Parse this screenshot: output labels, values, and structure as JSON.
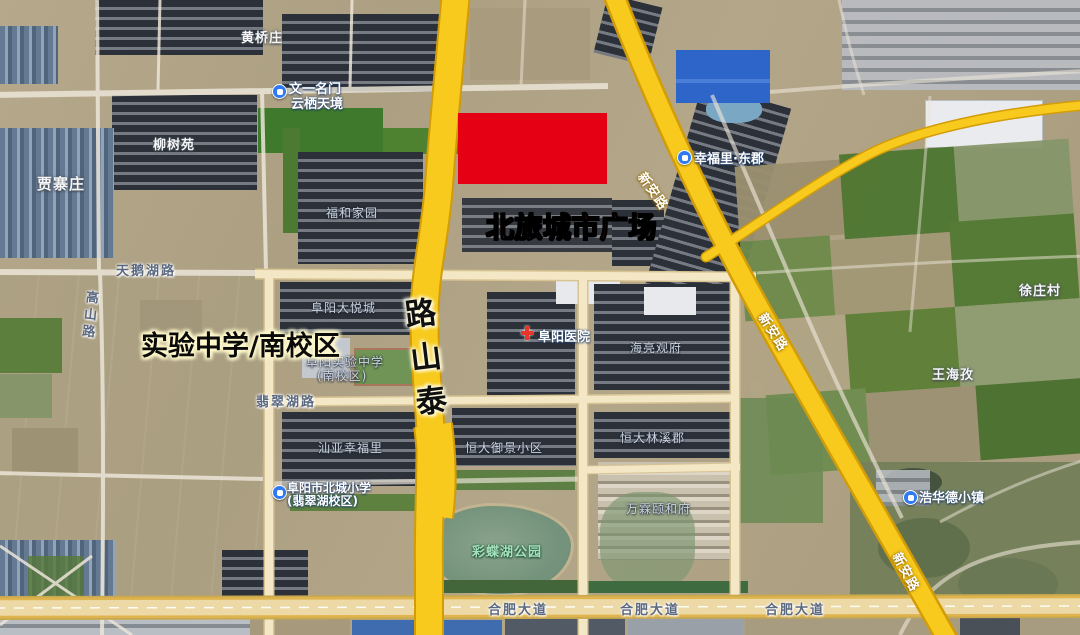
{
  "annotations": {
    "plaza": "北旅城市广场",
    "school": "实验中学/南校区",
    "taishan_chars": [
      "路",
      "山",
      "泰"
    ]
  },
  "roads": {
    "main_vertical": "泰山路",
    "diagonal": "新安路",
    "bottom_avenue": "合肥大道",
    "swan_lake_road": "天鹅湖路",
    "feicui_lake_road": "翡翠湖路",
    "gaoshan_road": "高山路"
  },
  "colors": {
    "highlight_box": "#e60013",
    "plaza_text": "#ff3800",
    "school_text": "#0a0a0a",
    "main_road_yellow": "#f7ca1d",
    "road_casing": "#d29c08"
  },
  "labels": [
    {
      "name": "poi-icon-wenyi",
      "kind": "icon-blue",
      "x": 272,
      "y": 84,
      "inter": true
    },
    {
      "name": "poi-wenyi-line1",
      "cls": "poi",
      "x": 289,
      "y": 78,
      "text": "文一名门",
      "inter": true
    },
    {
      "name": "poi-wenyi-line2",
      "cls": "poi",
      "x": 291,
      "y": 93,
      "text": "云栖天境",
      "inter": true
    },
    {
      "name": "poi-icon-xingfuli",
      "kind": "icon-blue",
      "x": 677,
      "y": 150,
      "inter": true
    },
    {
      "name": "poi-xingfuli",
      "cls": "poi",
      "x": 694,
      "y": 148,
      "text": "幸福里·东郡",
      "inter": true
    },
    {
      "name": "poi-icon-hospital",
      "kind": "icon-cross",
      "x": 520,
      "y": 325,
      "inter": true
    },
    {
      "name": "poi-hospital",
      "cls": "poi",
      "x": 538,
      "y": 326,
      "text": "阜阳医院",
      "inter": true
    },
    {
      "name": "poi-icon-beicheng-school",
      "kind": "icon-blue",
      "x": 272,
      "y": 485,
      "inter": true
    },
    {
      "name": "poi-beicheng-line1",
      "cls": "poi sm",
      "x": 287,
      "y": 479,
      "text": "阜阳市北城小学",
      "inter": true
    },
    {
      "name": "poi-beicheng-line2",
      "cls": "poi sm",
      "x": 287,
      "y": 492,
      "text": "(翡翠湖校区)",
      "inter": true
    },
    {
      "name": "poi-icon-haohuade",
      "kind": "icon-blue",
      "x": 903,
      "y": 490,
      "inter": true
    },
    {
      "name": "poi-haohuade",
      "cls": "poi",
      "x": 919,
      "y": 487,
      "text": "浩华德小镇",
      "inter": true
    },
    {
      "name": "village-jiazhaizhuang",
      "cls": "village lg",
      "x": 37,
      "y": 173,
      "text": "贾寨庄",
      "inter": false
    },
    {
      "name": "village-liushuyuan",
      "cls": "village",
      "x": 153,
      "y": 134,
      "text": "柳树苑",
      "inter": false
    },
    {
      "name": "village-huangqiaozhuang",
      "cls": "village",
      "x": 241,
      "y": 27,
      "text": "黄桥庄",
      "inter": false
    },
    {
      "name": "village-xuzhuangcun",
      "cls": "village",
      "x": 1019,
      "y": 280,
      "text": "徐庄村",
      "inter": false
    },
    {
      "name": "village-wanghaizi",
      "cls": "village",
      "x": 932,
      "y": 364,
      "text": "王海孜",
      "inter": false
    },
    {
      "name": "area-fuhe-jiayuan",
      "cls": "area",
      "x": 326,
      "y": 204,
      "text": "福和家园",
      "inter": false
    },
    {
      "name": "area-dayuecheng",
      "cls": "area",
      "x": 311,
      "y": 299,
      "text": "阜阳大悦城",
      "inter": false
    },
    {
      "name": "area-shiyan-line1",
      "cls": "area",
      "x": 306,
      "y": 353,
      "text": "阜阳实验中学",
      "inter": false
    },
    {
      "name": "area-shiyan-line2",
      "cls": "area",
      "x": 317,
      "y": 367,
      "text": "(南校区)",
      "inter": false
    },
    {
      "name": "area-shanya-xingfuli",
      "cls": "area",
      "x": 318,
      "y": 439,
      "text": "汕亚幸福里",
      "inter": false
    },
    {
      "name": "area-hengda-yujing",
      "cls": "area",
      "x": 465,
      "y": 439,
      "text": "恒大御景小区",
      "inter": false
    },
    {
      "name": "area-hengda-linxi",
      "cls": "area",
      "x": 620,
      "y": 429,
      "text": "恒大林溪郡",
      "inter": false
    },
    {
      "name": "area-wanlin-yihe",
      "cls": "area",
      "x": 626,
      "y": 500,
      "text": "万霖颐和府",
      "inter": false
    },
    {
      "name": "area-hailiang-guanfu",
      "cls": "area",
      "x": 630,
      "y": 339,
      "text": "海亮观府",
      "inter": false
    },
    {
      "name": "park-caidiehu",
      "cls": "park",
      "x": 472,
      "y": 541,
      "text": "彩蝶湖公园",
      "inter": false
    },
    {
      "name": "road-label-tianehu",
      "cls": "road",
      "x": 116,
      "y": 260,
      "text": "天鹅湖路",
      "inter": false
    },
    {
      "name": "road-label-feicui",
      "cls": "road",
      "x": 256,
      "y": 391,
      "text": "翡翠湖路",
      "inter": false
    },
    {
      "name": "road-label-gaoshan",
      "cls": "road vert",
      "x": 84,
      "y": 290,
      "rot": 6,
      "text": "高山路",
      "inter": false
    },
    {
      "name": "road-label-hefei-1",
      "cls": "road",
      "x": 488,
      "y": 599,
      "text": "合肥大道",
      "inter": false
    },
    {
      "name": "road-label-hefei-2",
      "cls": "road",
      "x": 620,
      "y": 599,
      "text": "合肥大道",
      "inter": false
    },
    {
      "name": "road-label-hefei-3",
      "cls": "road",
      "x": 765,
      "y": 599,
      "text": "合肥大道",
      "inter": false
    },
    {
      "name": "road-label-xinan-1",
      "cls": "road-y",
      "x": 633,
      "y": 181,
      "rot": 55,
      "text": "新安路",
      "inter": false
    },
    {
      "name": "road-label-xinan-2",
      "cls": "road-y",
      "x": 753,
      "y": 322,
      "rot": 57,
      "text": "新安路",
      "inter": false
    },
    {
      "name": "road-label-xinan-3",
      "cls": "road-y",
      "x": 886,
      "y": 562,
      "rot": 62,
      "text": "新安路",
      "inter": false
    }
  ]
}
